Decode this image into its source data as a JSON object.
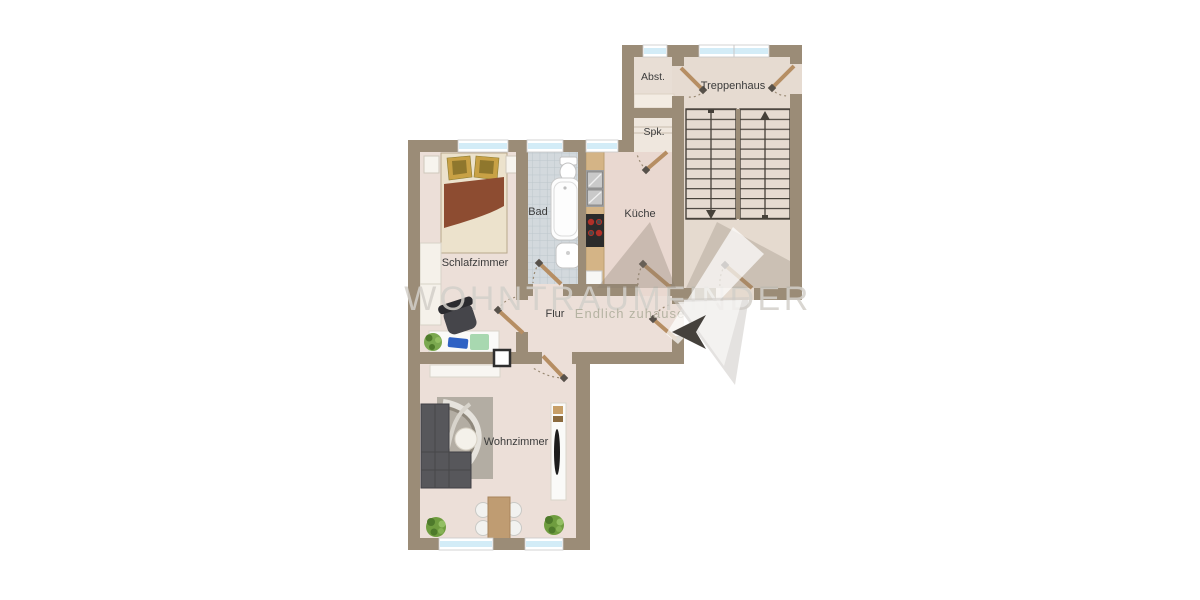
{
  "title": "Wohnungsgrundriss (apartment floor plan)",
  "rooms": {
    "abstellraum": {
      "label": "Abst."
    },
    "treppenhaus": {
      "label": "Treppenhaus"
    },
    "speisekammer": {
      "label": "Spk."
    },
    "bad": {
      "label": "Bad"
    },
    "kueche": {
      "label": "Küche"
    },
    "schlafzimmer": {
      "label": "Schlafzimmer"
    },
    "flur": {
      "label": "Flur"
    },
    "wohnzimmer": {
      "label": "Wohnzimmer"
    }
  },
  "watermark": {
    "brand": "WOHNTRAUMFINDER",
    "tagline": "Endlich zuhause"
  },
  "stairs": {
    "flights": 2,
    "treads_per_flight": 11,
    "left_flight_arrow": "down",
    "right_flight_arrow": "up"
  },
  "furniture_icons": [
    "double-bed",
    "pillows",
    "nightstand",
    "wardrobe",
    "desk",
    "office-chair",
    "plant",
    "toilet",
    "bathtub",
    "wash-basin",
    "kitchen-counter",
    "kitchen-sink",
    "stove",
    "corner-sofa",
    "rug",
    "coffee-table",
    "tv-sideboard",
    "sideboard",
    "dining-table",
    "dining-chair",
    "chimney-shaft",
    "shelf"
  ],
  "colors": {
    "wall": "#9b8c77",
    "floor_living": "#ecdfd8",
    "floor_kitchen": "#e9d8d0",
    "floor_stairwell": "#e6dbd1",
    "floor_pantry": "#efe7de",
    "bath_tile": "#d3d9dd",
    "window_glass": "#d3ecf7",
    "door_leaf": "#b68e63",
    "stair_line": "#46413a",
    "label_text": "#3b3b3b",
    "watermark_gray": "#d3d0ca",
    "tagline_olive": "#b3b1a0",
    "logo_dark_arrow": "#45413c"
  }
}
